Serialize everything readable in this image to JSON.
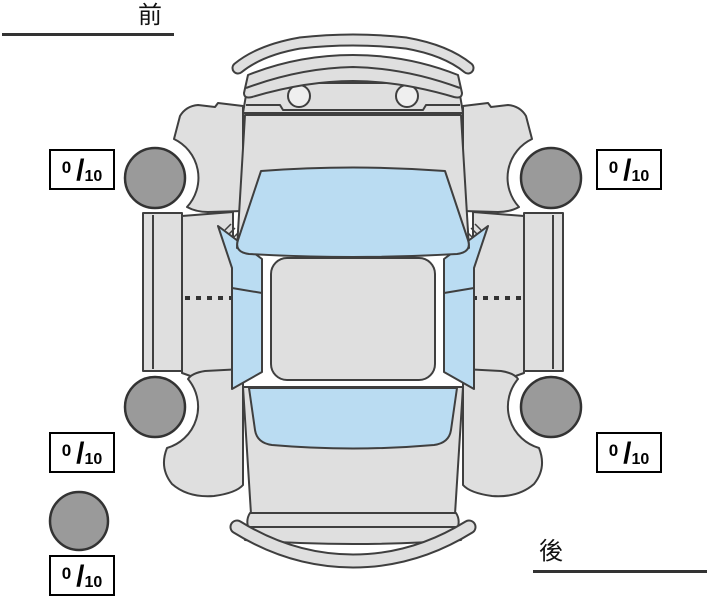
{
  "diagram": {
    "orientation_labels": {
      "front": "前",
      "rear": "後"
    },
    "parts": [
      "front-bumper",
      "hood",
      "washer-nozzles",
      "windshield",
      "roof",
      "side-windows",
      "door-panels",
      "front-fenders",
      "rear-quarter-panels",
      "rear-window",
      "trunk",
      "rear-bumper",
      "front-left-tire",
      "front-right-tire",
      "rear-left-tire",
      "rear-right-tire",
      "spare-tire"
    ]
  },
  "tire_ratings": {
    "separator": "/",
    "front_left": {
      "value": "0",
      "max": "10"
    },
    "front_right": {
      "value": "0",
      "max": "10"
    },
    "rear_left": {
      "value": "0",
      "max": "10"
    },
    "rear_right": {
      "value": "0",
      "max": "10"
    },
    "spare": {
      "value": "0",
      "max": "10"
    }
  },
  "colors": {
    "body": "#dfdfdf",
    "glass": "#badcf2",
    "tire": "#9a9a9a",
    "outline": "#3f3f3f",
    "text": "#000000",
    "background": "#ffffff"
  }
}
